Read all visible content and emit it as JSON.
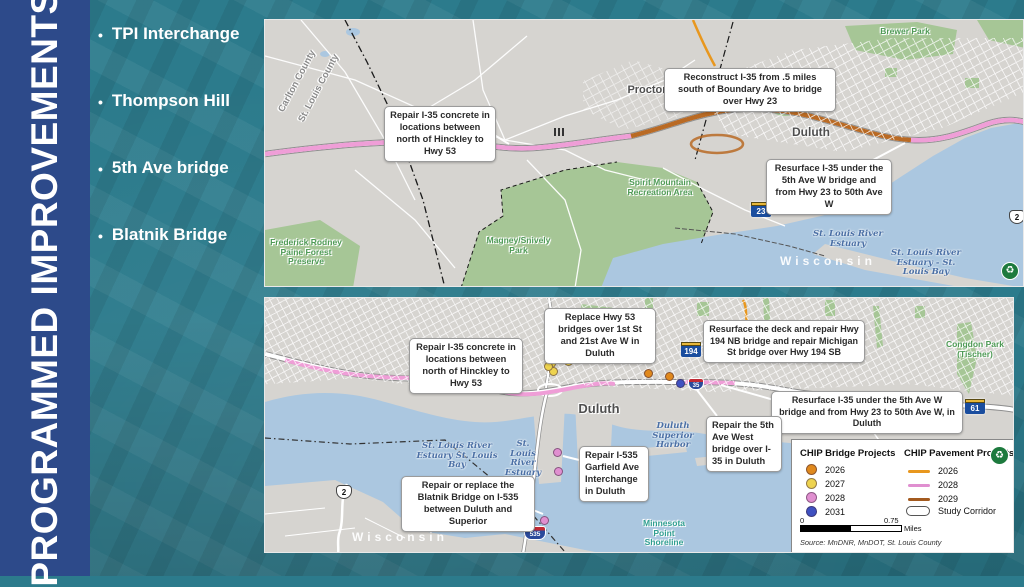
{
  "slide": {
    "title": "PROGRAMMED IMPROVEMENTS",
    "bullet_char": "•",
    "bullets": [
      "TPI Interchange",
      "Thompson Hill",
      "5th Ave bridge",
      "Blatnik Bridge"
    ]
  },
  "icons": {
    "logo_glyph": "♻"
  },
  "colors": {
    "sidebar_blue": "#2d4a8a",
    "background_teal": "#2c7b8c",
    "pavement_2026_orange": "#e8971e",
    "pavement_2028_pink": "#ef9ed7",
    "pavement_2029_brown": "#a35a1f",
    "bridge_2026_orange": "#e0891d",
    "bridge_2027_yellow": "#eed34f",
    "bridge_2028_pink": "#e08fd0",
    "bridge_2031_blue": "#3f51c1"
  },
  "map_top": {
    "callouts": [
      "Repair I-35 concrete in locations between north of Hinckley to Hwy 53",
      "Reconstruct I-35 from .5 miles south of Boundary Ave to bridge over Hwy 23",
      "Resurface I-35 under the 5th Ave W bridge and from Hwy 23 to 50th Ave W"
    ],
    "labels": {
      "county_a": "Carlton County",
      "county_b": "St. Louis County",
      "proctor": "Proctor",
      "duluth": "Duluth",
      "brewer_park": "Brewer Park",
      "bayview_park": "Bayview Park",
      "spirit_mountain": "Spirit Mountain Recreation Area",
      "indian_point": "Indian Point Campground",
      "frederick_rodney": "Frederick Rodney Paine Forest Preserve",
      "magney_snively": "Magney/Snively Park",
      "st_louis_river_estuary": "St. Louis River Estuary",
      "estuary_bay": "St. Louis River Estuary - St. Louis Bay",
      "wisconsin": "Wisconsin"
    },
    "shields": {
      "mn23": "23",
      "us2": "2"
    }
  },
  "map_bottom": {
    "callouts": [
      "Repair I-35 concrete in locations between north of Hinckley to Hwy 53",
      "Replace Hwy 53 bridges over 1st St and 21st Ave W in Duluth",
      "Resurface the deck and repair Hwy 194 NB bridge and repair Michigan St bridge over Hwy 194 SB",
      "Resurface I-35 under the 5th Ave W bridge and from Hwy 23 to 50th Ave W, in Duluth",
      "Repair the 5th Ave West bridge over I-35 in Duluth",
      "Repair I-535 Garfield Ave Interchange in Duluth",
      "Repair or replace the Blatnik Bridge on I-535 between Duluth and Superior"
    ],
    "labels": {
      "enger_park": "Enger Park",
      "duluth": "Duluth",
      "congdon_park": "Congdon Park (Tischer)",
      "duluth_superior_harbor": "Duluth Superior Harbor",
      "estuary_bay": "St. Louis River Estuary St. Louis Bay",
      "st_louis_river_estuary": "St. Louis River Estuary",
      "minnesota_point": "Minnesota Point Shoreline",
      "wisconsin": "Wisconsin"
    },
    "shields": {
      "mn194": "194",
      "mn61": "61",
      "us2": "2",
      "i535": "535",
      "i35": "35"
    }
  },
  "legend": {
    "bridge_title": "CHIP Bridge Projects",
    "pavement_title": "CHIP Pavement Projects",
    "bridge_items": [
      {
        "year": "2026",
        "color": "#e0891d"
      },
      {
        "year": "2027",
        "color": "#eed34f"
      },
      {
        "year": "2028",
        "color": "#e08fd0"
      },
      {
        "year": "2031",
        "color": "#3f51c1"
      }
    ],
    "pavement_items": [
      {
        "year": "2026",
        "color": "#e8971e"
      },
      {
        "year": "2028",
        "color": "#e08fd0"
      },
      {
        "year": "2029",
        "color": "#a35a1f"
      }
    ],
    "study_corridor_label": "Study Corridor",
    "scale_start": "0",
    "scale_mid": "0.75",
    "scale_unit": "Miles",
    "source": "Source: MnDNR, MnDOT, St. Louis County"
  }
}
